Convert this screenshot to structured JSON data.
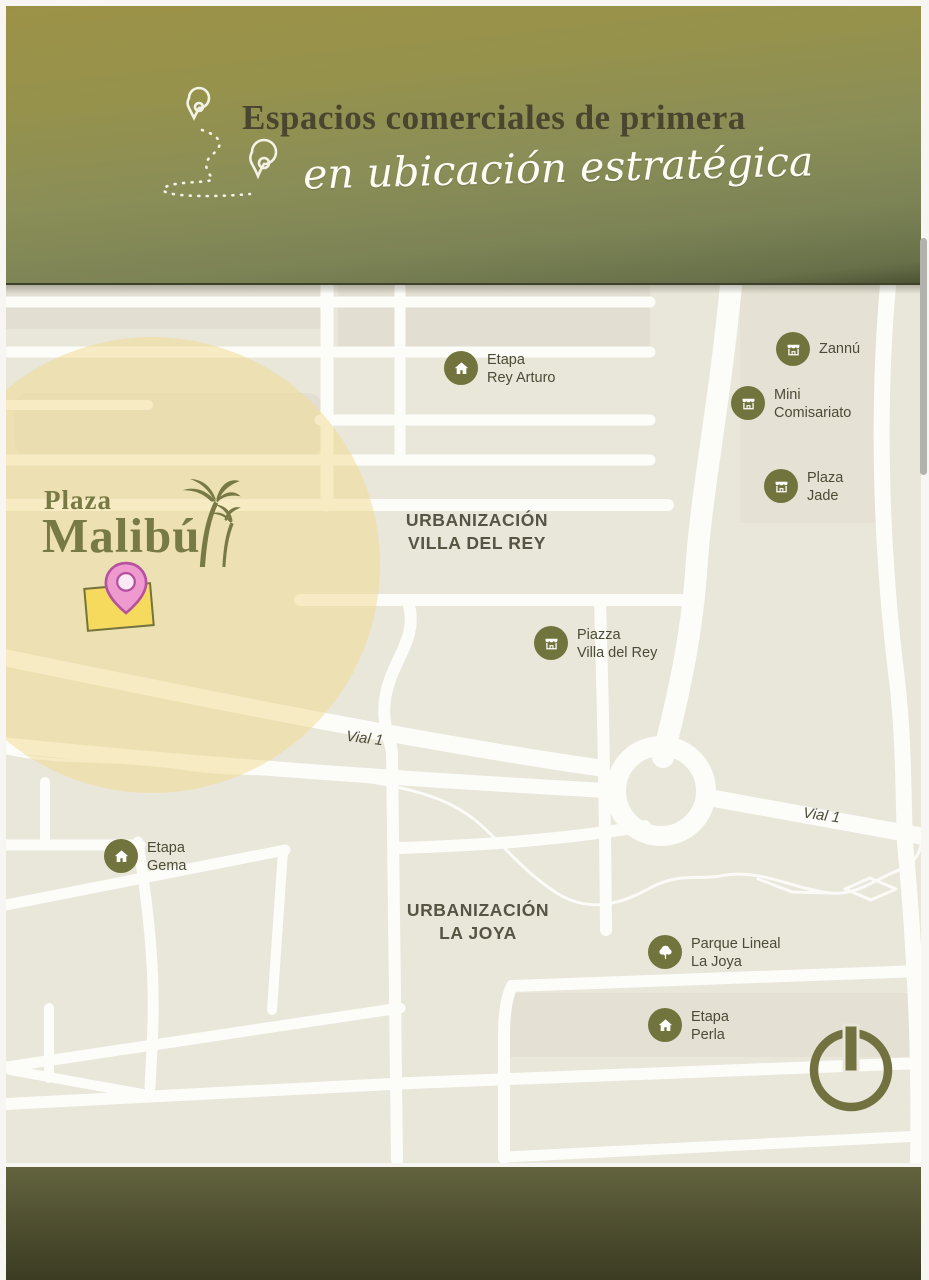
{
  "header": {
    "title": "Espacios comerciales de primera",
    "subtitle": "en ubicación estratégica"
  },
  "map": {
    "logo": {
      "line1": "Plaza",
      "line2": "Malibú"
    },
    "area_labels": {
      "villa_del_rey": {
        "line1": "URBANIZACIÓN",
        "line2": "VILLA DEL REY"
      },
      "la_joya": {
        "line1": "URBANIZACIÓN",
        "line2": "LA JOYA"
      }
    },
    "road_labels": [
      "Vial 1",
      "Vial 1"
    ],
    "pois": [
      {
        "id": "etapa-rey-arturo",
        "icon": "house",
        "line1": "Etapa",
        "line2": "Rey Arturo"
      },
      {
        "id": "zannu",
        "icon": "store",
        "line1": "Zannú",
        "line2": ""
      },
      {
        "id": "mini-comisariato",
        "icon": "store",
        "line1": "Mini",
        "line2": "Comisariato"
      },
      {
        "id": "plaza-jade",
        "icon": "store",
        "line1": "Plaza",
        "line2": "Jade"
      },
      {
        "id": "piazza-villa-del-rey",
        "icon": "store",
        "line1": "Piazza",
        "line2": "Villa del Rey"
      },
      {
        "id": "etapa-gema",
        "icon": "house",
        "line1": "Etapa",
        "line2": "Gema"
      },
      {
        "id": "parque-lineal-la-joya",
        "icon": "tree",
        "line1": "Parque Lineal",
        "line2": "La Joya"
      },
      {
        "id": "etapa-perla",
        "icon": "house",
        "line1": "Etapa",
        "line2": "Perla"
      }
    ]
  },
  "colors": {
    "brand_olive": "#72743e",
    "map_background": "#e9e6da",
    "highlight_yellow": "#f2e2a4",
    "pin_pink": "#ef9ace",
    "building_yellow": "#f6da5e"
  }
}
